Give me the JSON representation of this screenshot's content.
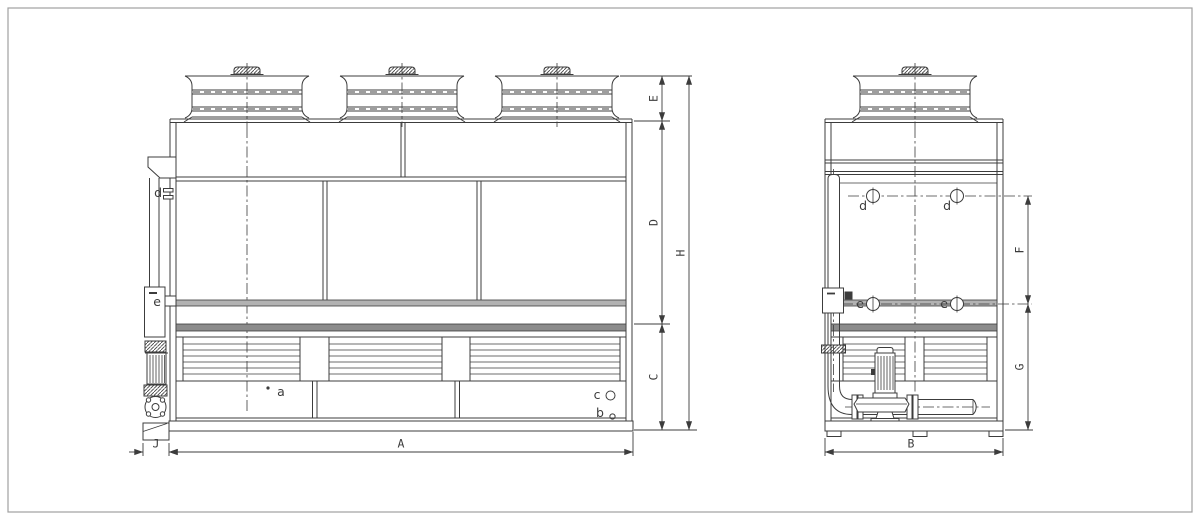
{
  "labels": {
    "dims": {
      "A": "A",
      "B": "B",
      "C": "C",
      "D": "D",
      "E": "E",
      "F": "F",
      "G": "G",
      "H": "H",
      "J": "J"
    },
    "parts": {
      "a": "a",
      "b": "b",
      "c": "c",
      "d": "d",
      "e": "e"
    }
  },
  "colors": {
    "line": "#3c3c3c",
    "band-light": "#b2b2b2",
    "band-dark": "#8c8c8c",
    "background": "#ffffff",
    "frame": "#a0a0a0"
  }
}
